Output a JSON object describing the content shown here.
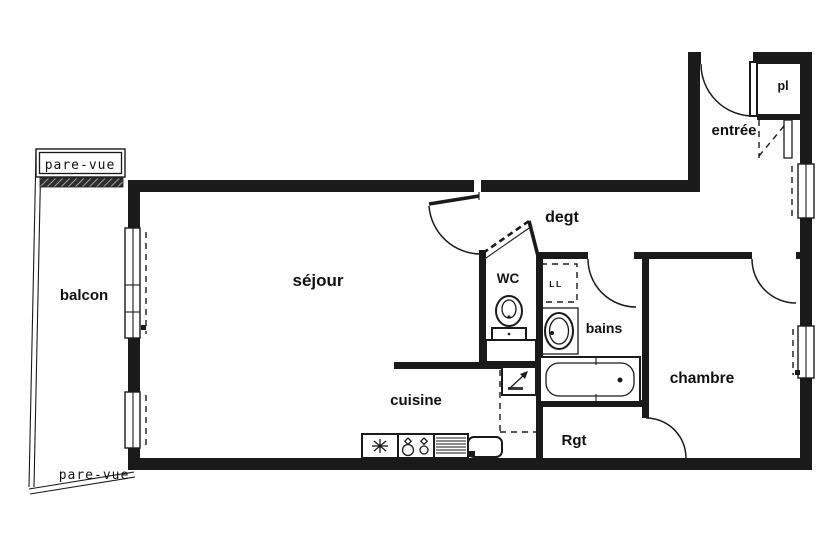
{
  "document": {
    "type": "apartment-floor-plan",
    "style": "scanned black-and-white architectural drawing"
  },
  "rooms": {
    "balcon": {
      "label": "balcon"
    },
    "sejour": {
      "label": "séjour"
    },
    "cuisine": {
      "label": "cuisine"
    },
    "degt": {
      "label": "degt"
    },
    "entree": {
      "label": "entrée"
    },
    "pl": {
      "label": "pl"
    },
    "wc": {
      "label": "WC"
    },
    "bains": {
      "label": "bains"
    },
    "chambre": {
      "label": "chambre"
    },
    "rgt": {
      "label": "Rgt"
    }
  },
  "annotations": {
    "pare_vue_top": "pare-vue",
    "pare_vue_bottom": "pare-vue",
    "washing_machine": "LL"
  },
  "fixtures": [
    "entry-door-icon",
    "sejour-door-icon",
    "wc-door-icon",
    "bains-door-icon",
    "chambre-door-icon",
    "rgt-door-icon",
    "toilet-icon",
    "washbasin-icon",
    "bathtub-icon",
    "washing-machine-box",
    "duct-arrow-icon",
    "fridge-fan-icon",
    "stove-burners-icon",
    "drainboard-icon",
    "sink-icon",
    "window-icon"
  ],
  "colors": {
    "ink": "#1a1a1a",
    "paper": "#ffffff",
    "hatch": "#2e2e2e"
  }
}
